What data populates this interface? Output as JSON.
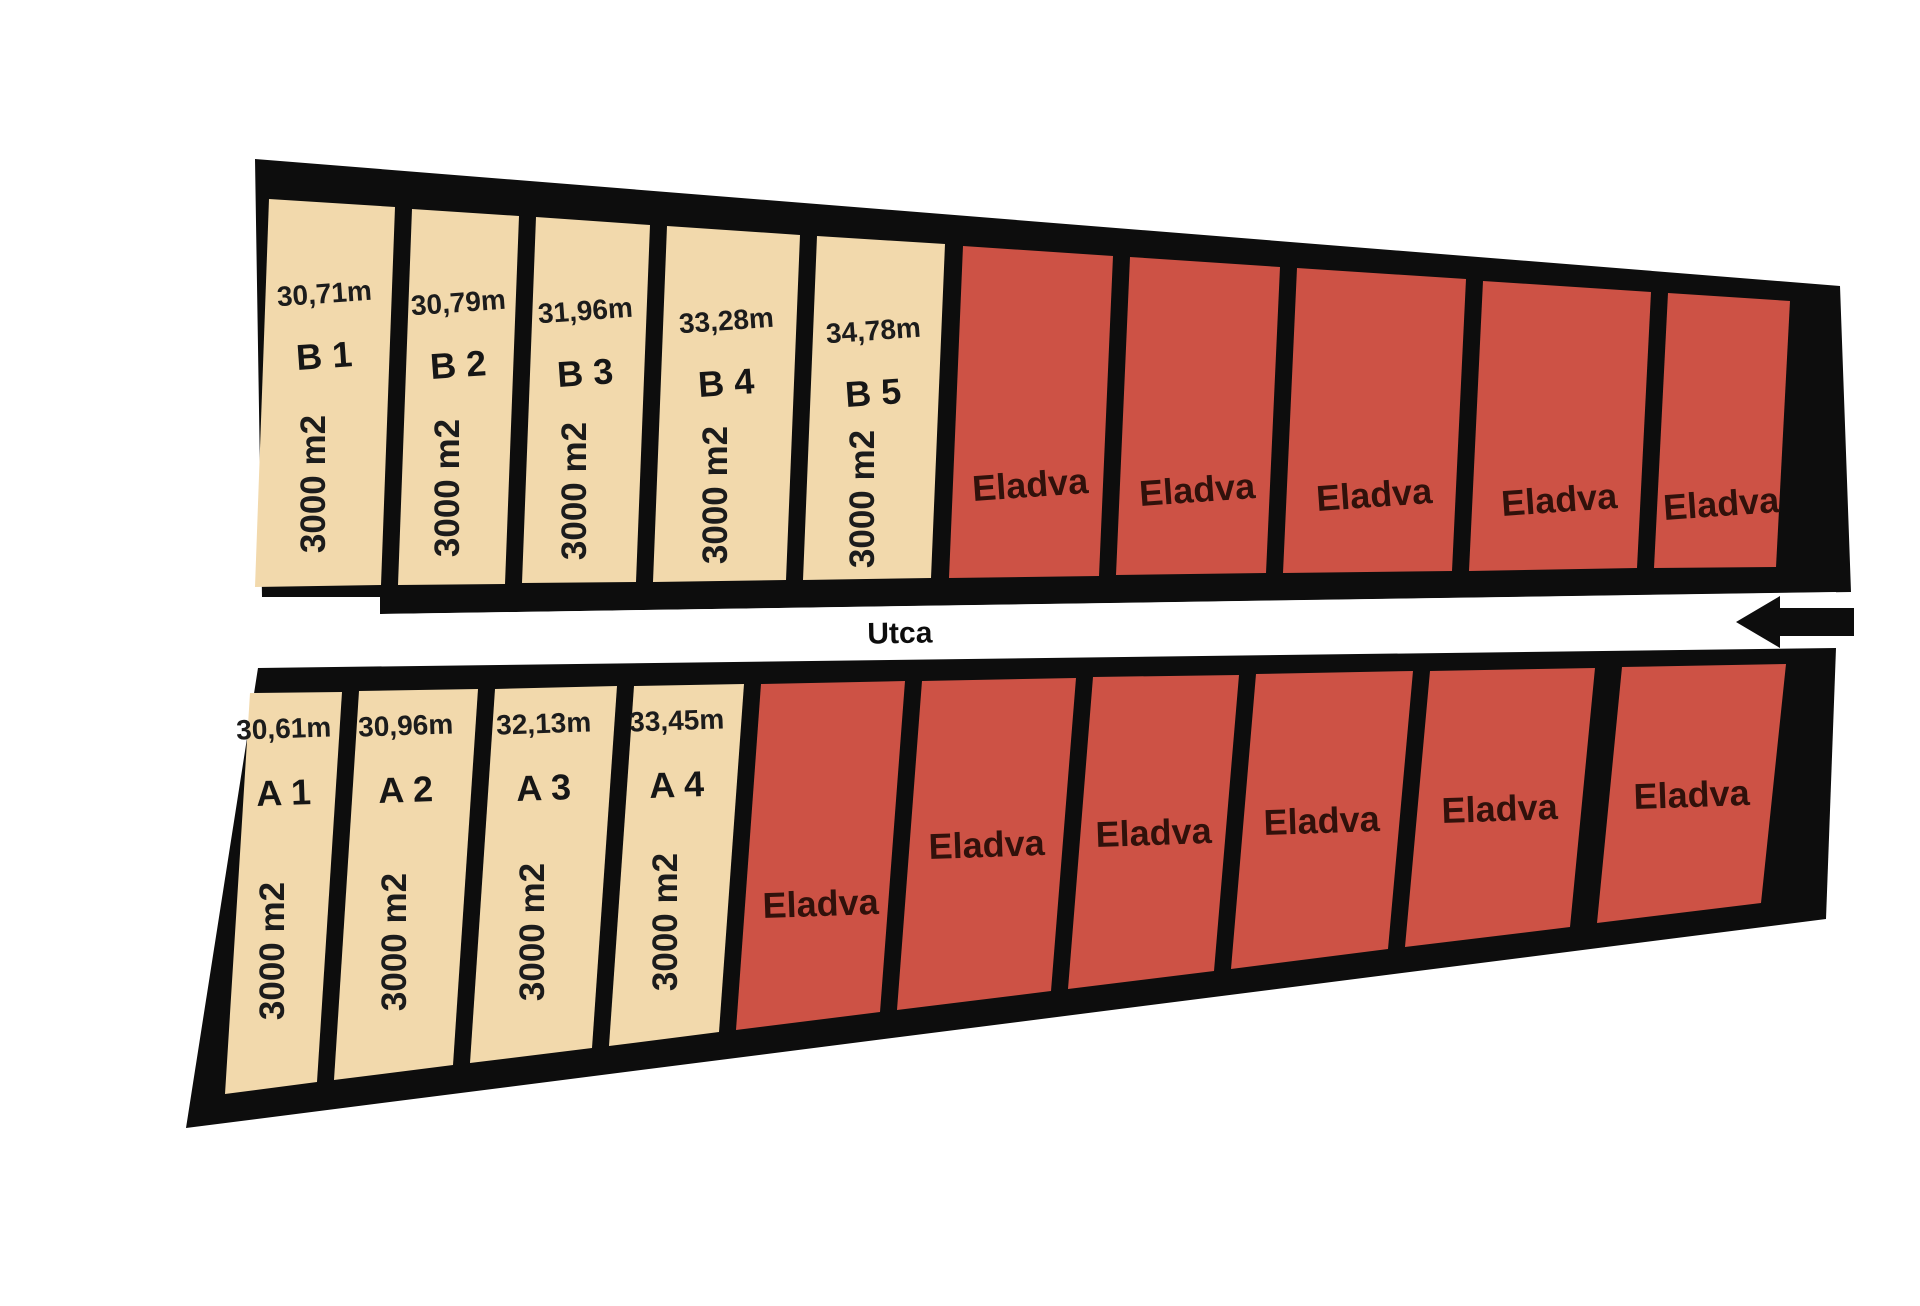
{
  "street": {
    "label": "Utca",
    "arrow_direction": "left"
  },
  "colors": {
    "available": "#F2D9AC",
    "sold": "#CD5245",
    "border": "#0D0D0D",
    "street_fill": "#FFFFFF",
    "label_text": "#1C1C1C",
    "sold_text": "#31110B"
  },
  "rows": [
    {
      "name": "B",
      "plots": [
        {
          "name": "B 1",
          "width": "30,71m",
          "area": "3000 m2",
          "status": "available"
        },
        {
          "name": "B 2",
          "width": "30,79m",
          "area": "3000 m2",
          "status": "available"
        },
        {
          "name": "B 3",
          "width": "31,96m",
          "area": "3000 m2",
          "status": "available"
        },
        {
          "name": "B 4",
          "width": "33,28m",
          "area": "3000 m2",
          "status": "available"
        },
        {
          "name": "B 5",
          "width": "34,78m",
          "area": "3000 m2",
          "status": "available"
        },
        {
          "label": "Eladva",
          "status": "sold"
        },
        {
          "label": "Eladva",
          "status": "sold"
        },
        {
          "label": "Eladva",
          "status": "sold"
        },
        {
          "label": "Eladva",
          "status": "sold"
        },
        {
          "label": "Eladva",
          "status": "sold"
        }
      ]
    },
    {
      "name": "A",
      "plots": [
        {
          "name": "A 1",
          "width": "30,61m",
          "area": "3000 m2",
          "status": "available"
        },
        {
          "name": "A 2",
          "width": "30,96m",
          "area": "3000 m2",
          "status": "available"
        },
        {
          "name": "A 3",
          "width": "32,13m",
          "area": "3000 m2",
          "status": "available"
        },
        {
          "name": "A 4",
          "width": "33,45m",
          "area": "3000 m2",
          "status": "available"
        },
        {
          "label": "Eladva",
          "status": "sold"
        },
        {
          "label": "Eladva",
          "status": "sold"
        },
        {
          "label": "Eladva",
          "status": "sold"
        },
        {
          "label": "Eladva",
          "status": "sold"
        },
        {
          "label": "Eladva",
          "status": "sold"
        },
        {
          "label": "Eladva",
          "status": "sold"
        }
      ]
    }
  ]
}
